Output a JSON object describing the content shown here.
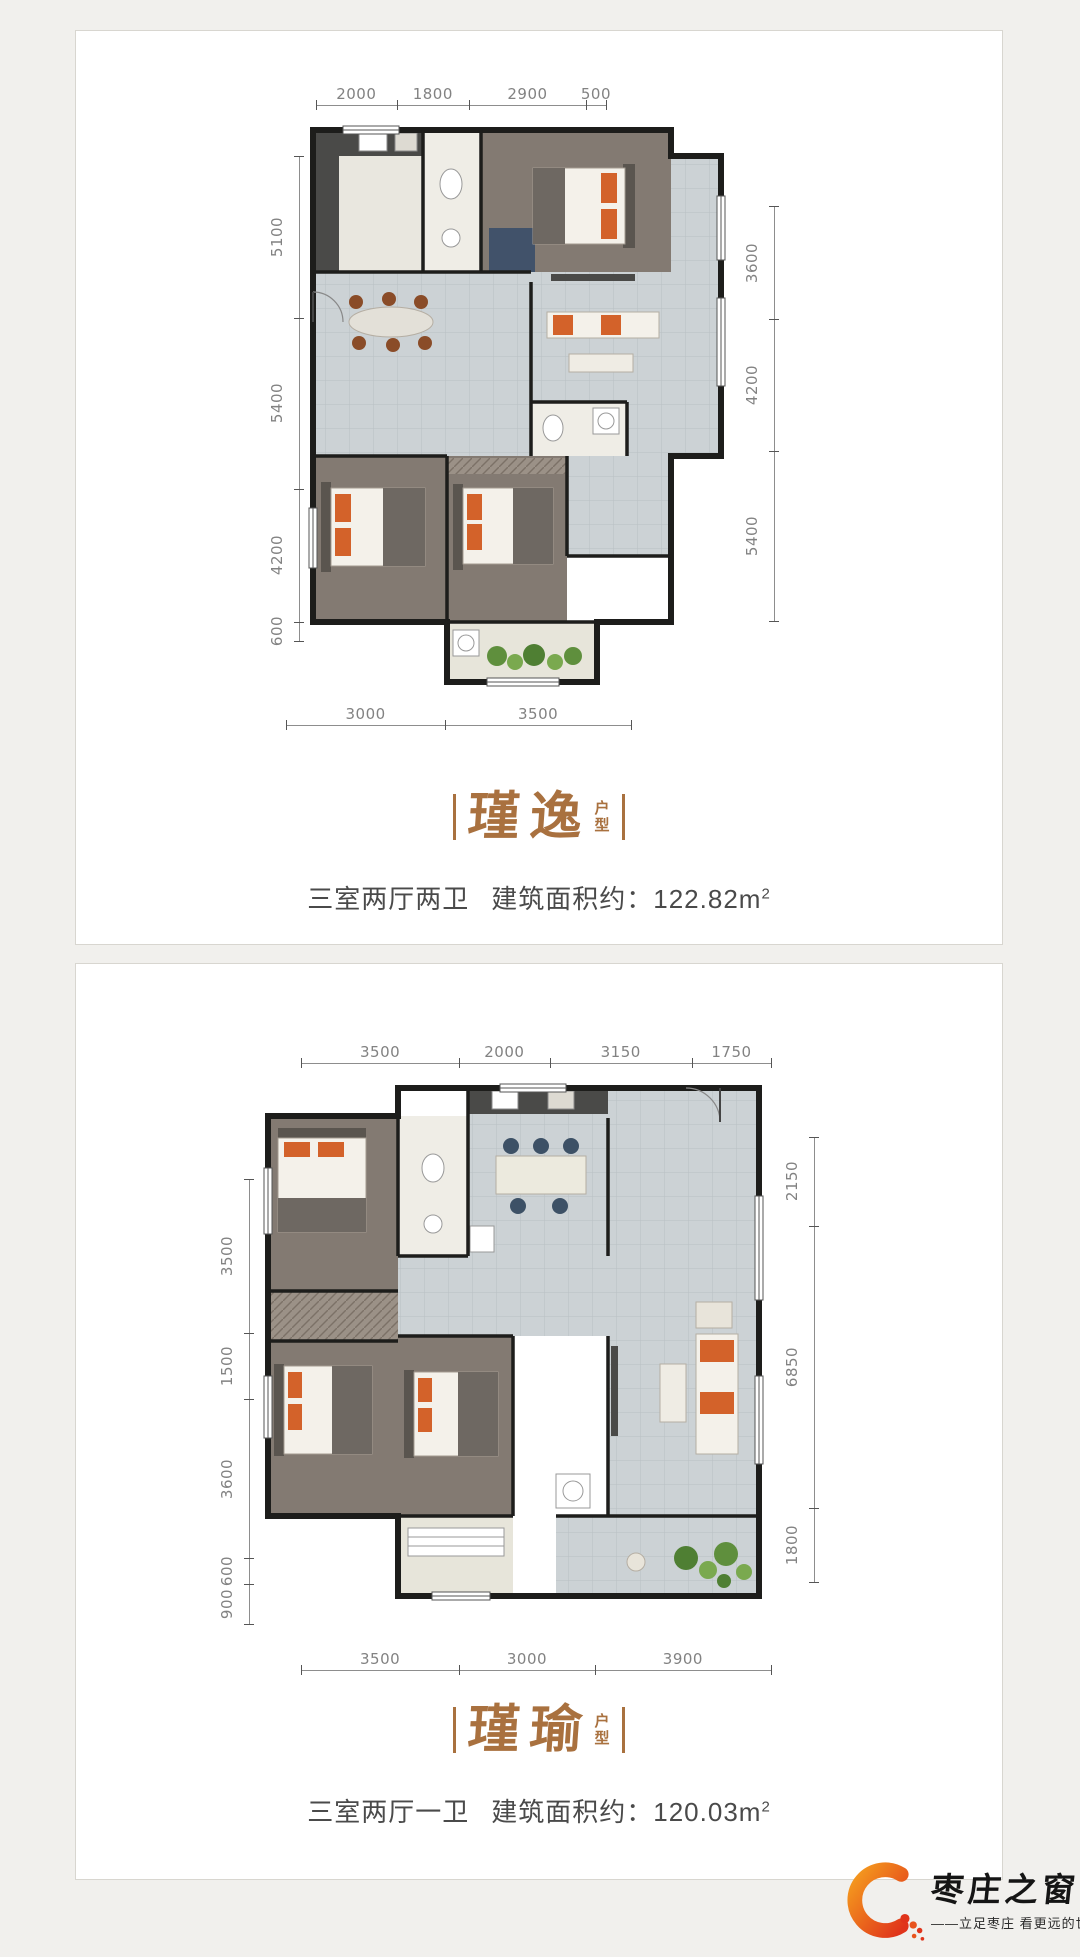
{
  "cards": [
    {
      "title": "瑾逸",
      "title_suffix": "户型",
      "layout_text": "三室两厅两卫",
      "area_label": "建筑面积约：",
      "area_value": "122.82m",
      "area_sup": "2",
      "dims": {
        "top": [
          "2000",
          "1800",
          "2900",
          "500"
        ],
        "left": [
          "5100",
          "5400",
          "4200",
          "600"
        ],
        "right": [
          "3600",
          "4200",
          "5400"
        ],
        "bottom": [
          "3000",
          "3500"
        ]
      }
    },
    {
      "title": "瑾瑜",
      "title_suffix": "户型",
      "layout_text": "三室两厅一卫",
      "area_label": "建筑面积约：",
      "area_value": "120.03m",
      "area_sup": "2",
      "dims": {
        "top": [
          "3500",
          "2000",
          "3150",
          "1750"
        ],
        "left": [
          "3500",
          "1500",
          "3600",
          "600",
          "900"
        ],
        "right": [
          "2150",
          "6850",
          "1800"
        ],
        "bottom": [
          "3500",
          "3000",
          "3900"
        ]
      }
    }
  ],
  "logo": {
    "brand": "枣庄之窗",
    "tagline": "——立足枣庄 看更远的世界——"
  },
  "colors": {
    "title_brown": "#a9713f",
    "desc_gray": "#4a4a4a",
    "dim_gray": "#828282",
    "logo_orange": "#e8541e",
    "page_bg": "#f1f0ed"
  }
}
